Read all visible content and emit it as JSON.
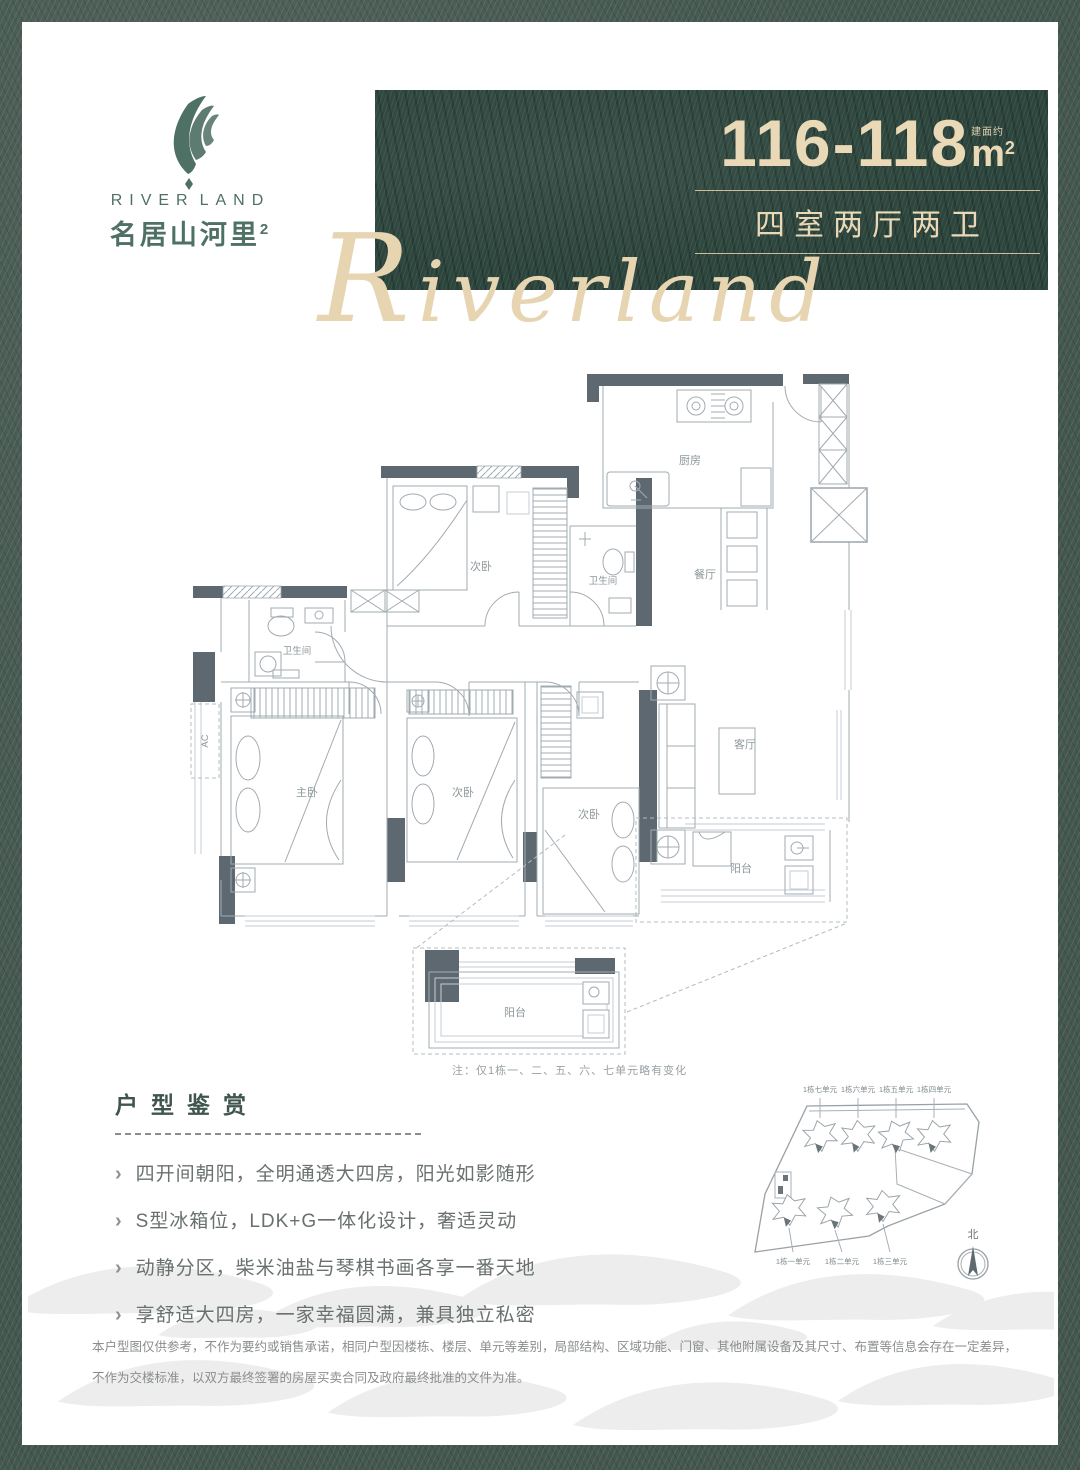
{
  "brand": {
    "name_en_left": "RIVER",
    "name_en_right": "LAND",
    "name_cn": "名居山河里",
    "name_cn_sup": "2",
    "script": "Riverland"
  },
  "banner": {
    "area_range": "116-118",
    "area_prefix": "建面约",
    "area_unit": "m",
    "area_unit_sup": "2",
    "layout": "四室两厅两卫"
  },
  "floorplan": {
    "rooms": {
      "kitchen": "厨房",
      "dining": "餐厅",
      "bath": "卫生间",
      "secondary": "次卧",
      "master": "主卧",
      "living": "客厅",
      "balcony": "阳台",
      "ac": "AC"
    },
    "note": "注：仅1栋一、二、五、六、七单元略有变化"
  },
  "features": {
    "title": "户型鉴赏",
    "items": [
      "四开间朝阳，全明通透大四房，阳光如影随形",
      "S型冰箱位，LDK+G一体化设计，奢适灵动",
      "动静分区，柴米油盐与琴棋书画各享一番天地",
      "享舒适大四房，一家幸福圆满，兼具独立私密"
    ]
  },
  "siteplan": {
    "units_top": [
      "1栋七单元",
      "1栋六单元",
      "1栋五单元",
      "1栋四单元"
    ],
    "units_bottom": [
      "1栋一单元",
      "1栋二单元",
      "1栋三单元"
    ],
    "north_label": "北"
  },
  "disclaimer": "本户型图仅供参考，不作为要约或销售承诺，相同户型因楼栋、楼层、单元等差别，局部结构、区域功能、门窗、其他附属设备及其尺寸、布置等信息会存在一定差异，不作为交楼标准，以双方最终签署的房屋买卖合同及政府最终批准的文件为准。",
  "colors": {
    "frame_green": "#44574e",
    "banner_green": "#2d463d",
    "champagne": "#ead9b6",
    "logo_green": "#4f7064",
    "wall_gray": "#5d6870",
    "line_gray": "#a2abb2"
  }
}
